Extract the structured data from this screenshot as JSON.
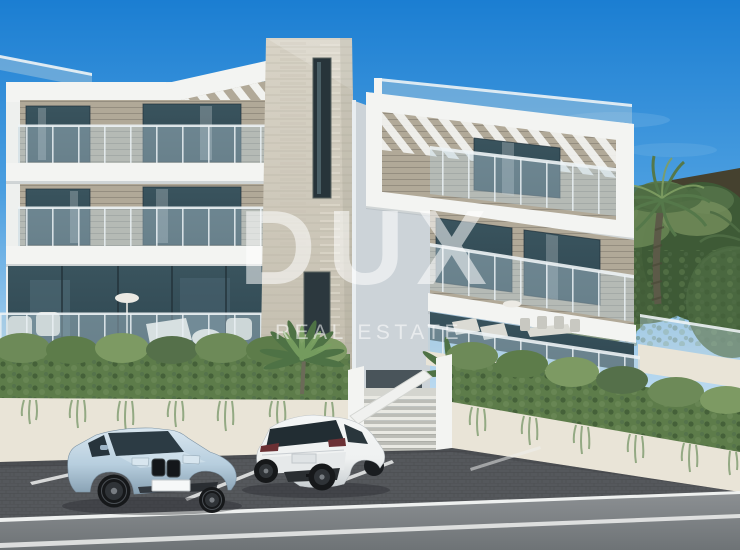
{
  "watermark": {
    "brand": "DUX",
    "tagline": "REAL ESTATE"
  },
  "colors": {
    "sky_top": "#1b7ed2",
    "sky_mid": "#4c9fe0",
    "sky_low": "#9ecbec",
    "sky_horizon": "#cfe4f2",
    "building_white": "#f3f4f2",
    "building_side": "#ccd3d8",
    "wall_warm": "#e9e4d7",
    "slat_wood": "#b1a998",
    "stone": "#d8d3c6",
    "stone_dark": "#c2bcad",
    "glass_dark": "#2f4751",
    "railing_glass": "#b9d2dd",
    "green_dark": "#415d37",
    "green_mid": "#5d7c4a",
    "green_light": "#84a066",
    "hill": "#45412f",
    "palm_trunk": "#5c5a48",
    "asphalt": "#55585c",
    "road_light": "#8b8f92",
    "road_dark": "#6e7376",
    "line_white": "#eef0ef",
    "car_blue": "#b7cede",
    "car_blue_dark": "#87a0b2",
    "car_white": "#eff1f1",
    "watermark_white": "rgba(255,255,255,0.55)"
  }
}
